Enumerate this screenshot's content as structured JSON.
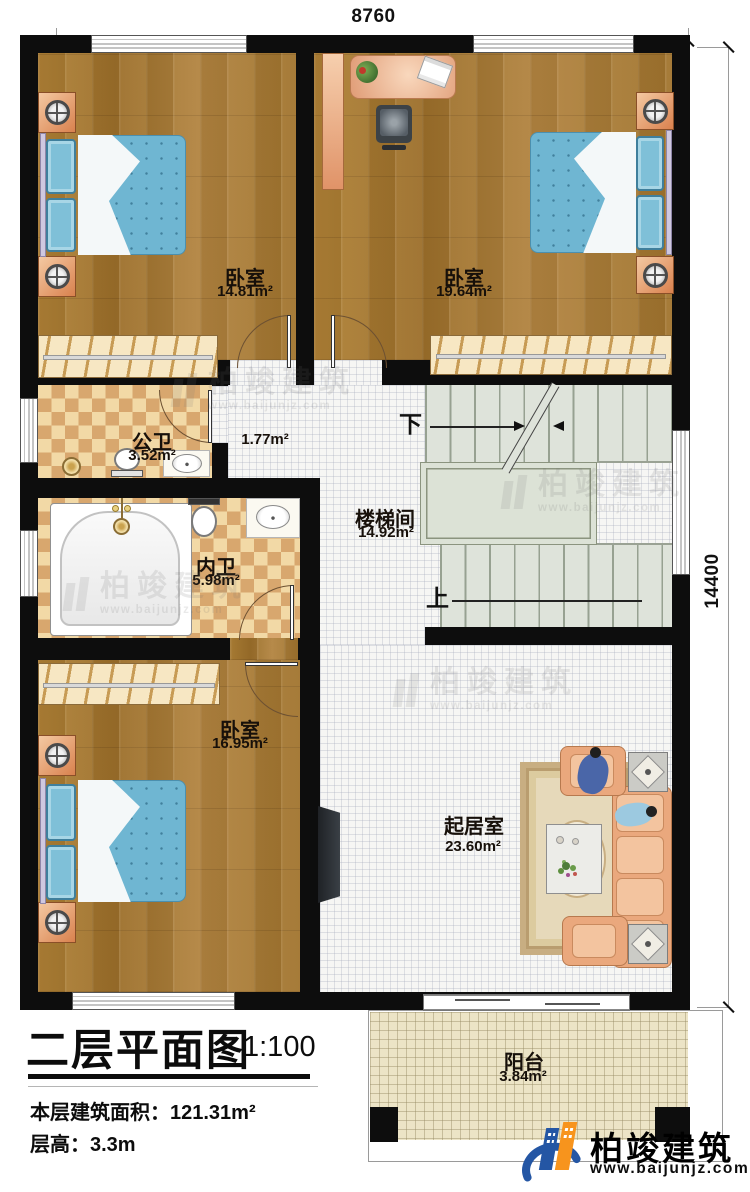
{
  "dimensions": {
    "top": "8760",
    "right": "14400"
  },
  "rooms": {
    "bedroom_top_left": {
      "name": "卧室",
      "area": "14.81m²"
    },
    "bedroom_top_right": {
      "name": "卧室",
      "area": "19.64m²"
    },
    "public_bath": {
      "name": "公卫",
      "area": "3.52m²"
    },
    "corridor": {
      "area": "1.77m²"
    },
    "stairwell": {
      "name": "楼梯间",
      "area": "14.92m²"
    },
    "private_bath": {
      "name": "内卫",
      "area": "5.98m²"
    },
    "bedroom_bottom": {
      "name": "卧室",
      "area": "16.95m²"
    },
    "living": {
      "name": "起居室",
      "area": "23.60m²"
    },
    "balcony": {
      "name": "阳台",
      "area": "3.84m²"
    }
  },
  "stairs": {
    "down": "下",
    "up": "上"
  },
  "title_block": {
    "title": "二层平面图",
    "scale": "1:100",
    "floor_area_label": "本层建筑面积：",
    "floor_area_value": "121.31m²",
    "floor_height_label": "层高：",
    "floor_height_value": "3.3m"
  },
  "brand": {
    "name": "柏竣建筑",
    "website": "www.baijunjz.com"
  },
  "watermark": {
    "name": "柏竣建筑",
    "website": "www.baijunjz.com"
  },
  "colors": {
    "wall": "#0d0d0d",
    "wood": "#a97b31",
    "tile_light": "#f2d9a6",
    "tile_dark": "#d8a76e",
    "stair_floor": "#dee3da",
    "balcony_floor": "#ece4c6",
    "bed_blue": "#6fb6d2",
    "brand_blue": "#2456a4",
    "brand_orange": "#f7941d"
  }
}
